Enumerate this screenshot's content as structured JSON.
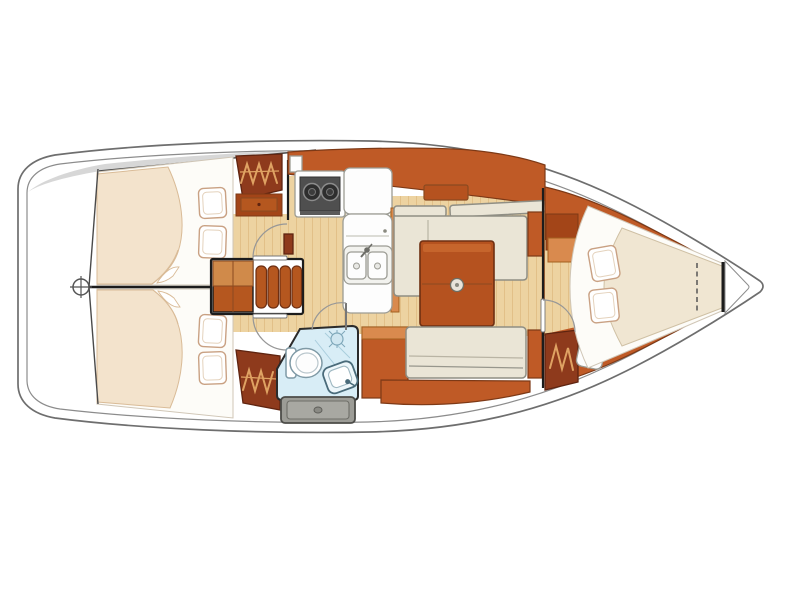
{
  "diagram": {
    "type": "boat-interior-layout-plan",
    "description": "Top-down accommodation plan of a sailing yacht, bow to the right",
    "orientation": {
      "stern": "left",
      "bow": "right"
    },
    "features": {
      "stern_platform": "Stern platform",
      "helm": "Helm position",
      "cockpit": "Cockpit side deck",
      "aft_cabin_port": "Aft double cabin (port)",
      "aft_cabin_starboard": "Aft double cabin (starboard)",
      "hanging_locker": "Hanging locker",
      "dresser": "Dresser",
      "companionway": "Companionway steps",
      "galley": "Galley",
      "stove": "Two-burner stove",
      "refrigerator": "Refrigerator / counter",
      "double_sink": "Double sink",
      "head": "Head (bathroom) with shower",
      "toilet": "Marine toilet",
      "washbasin": "Washbasin",
      "shower_drain": "Shower drain",
      "engine_hatch": "Locker hatch",
      "salon": "Salon",
      "settee_port": "L-shaped settee (port)",
      "settee_starboard": "Straight settee (starboard)",
      "salon_table": "Salon table",
      "forward_cabin": "Forward V-berth cabin",
      "v_berth": "V-berth",
      "bow_deck": "Bow / anchor locker",
      "doors": "Door swings",
      "pillows": "Pillows"
    },
    "counts": {
      "cabins": 3,
      "berth_pillows": 6,
      "stove_burners": 2,
      "sink_basins": 2
    }
  },
  "colors": {
    "hull-line": "#6e6e6e",
    "deck-line": "#8c8c8c",
    "cockpit-gray": "#d7d7d7",
    "wall-line": "#4a4a4a",
    "line-black": "#1c1c1c",
    "wood-mid": "#bf5a26",
    "wood-dark": "#8e3a1c",
    "wood-rust": "#a34518",
    "wood-light": "#d98a4e",
    "wood-edge": "#7d3916",
    "hanger-tan": "#dfa263",
    "table-wood": "#b5521f",
    "table-edge": "#6e2f12",
    "bed-beige": "#f3e3cc",
    "bed-edge": "#d9bb97",
    "bed-white": "#fdfcf8",
    "mattress-cream": "#f0e6d2",
    "mattress-edge": "#cfc0a4",
    "pillow-white": "#ffffff",
    "pillow-edge": "#c9a183",
    "cushion-cream": "#eae5d6",
    "cushion-edge": "#8f8e84",
    "counter-white": "#fdfdfd",
    "counter-edge": "#9c9c94",
    "stove-panel": "#4f4f4f",
    "burner-dark": "#2e2e2e",
    "head-blue": "#d8edf6",
    "head-line": "#a9cddd",
    "fixture-line": "#7f9aa6",
    "hatch-gray": "#9c9c96",
    "hatch-edge": "#4c4c48",
    "sole-plank": "#edd3a1",
    "sole-seam": "#d8b274",
    "arc-gray": "#979797"
  }
}
